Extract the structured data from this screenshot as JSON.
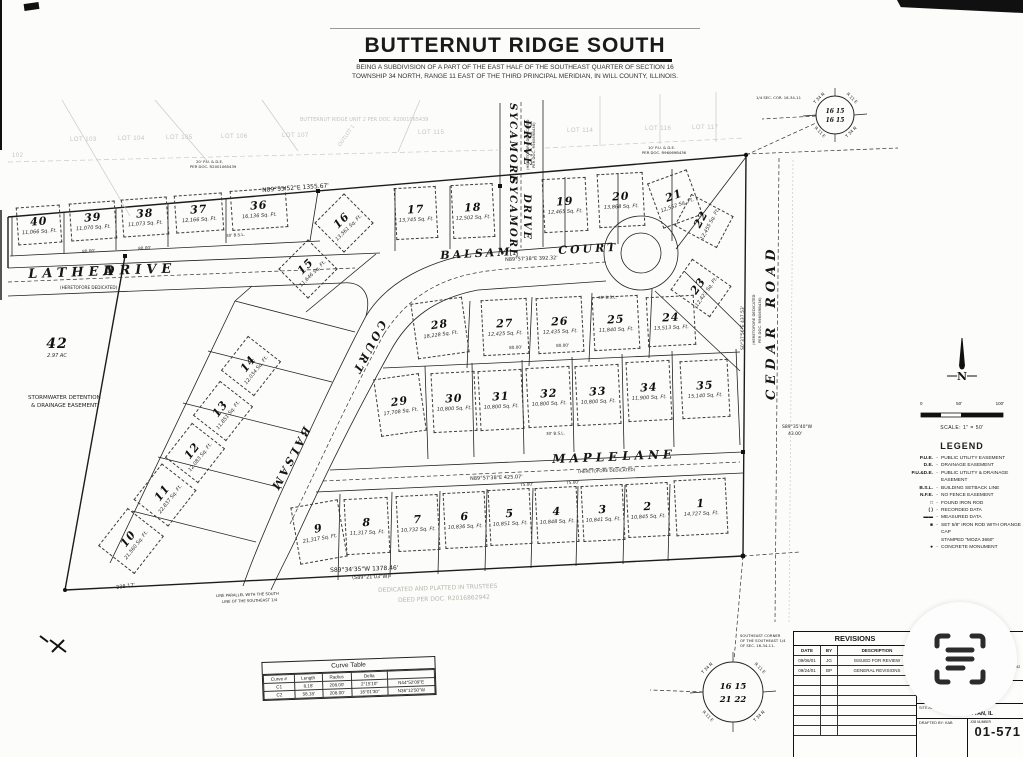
{
  "header": {
    "title": "BUTTERNUT RIDGE SOUTH",
    "subtitle_line1": "BEING A SUBDIVISION OF A PART OF THE EAST HALF OF THE SOUTHEAST QUARTER OF SECTION 16",
    "subtitle_line2": "TOWNSHIP 34 NORTH, RANGE 11 EAST OF THE THIRD PRINCIPAL MERIDIAN, IN WILL COUNTY, ILLINOIS."
  },
  "plat": {
    "lots": [
      {
        "n": "1",
        "area": "14,727 Sq. Ft.",
        "x": 700,
        "y": 506,
        "rot": -3,
        "w": 50,
        "h": 54
      },
      {
        "n": "2",
        "area": "10,845 Sq. Ft.",
        "x": 647,
        "y": 509,
        "rot": -3,
        "w": 40,
        "h": 52
      },
      {
        "n": "3",
        "area": "10,841 Sq. Ft.",
        "x": 602,
        "y": 512,
        "rot": -3,
        "w": 40,
        "h": 54
      },
      {
        "n": "4",
        "area": "10,848 Sq. Ft.",
        "x": 556,
        "y": 514,
        "rot": -3,
        "w": 40,
        "h": 54
      },
      {
        "n": "5",
        "area": "10,851 Sq. Ft.",
        "x": 509,
        "y": 516,
        "rot": -3,
        "w": 40,
        "h": 54
      },
      {
        "n": "6",
        "area": "10,836 Sq. Ft.",
        "x": 464,
        "y": 519,
        "rot": -3,
        "w": 40,
        "h": 54
      },
      {
        "n": "7",
        "area": "10,732 Sq. Ft.",
        "x": 417,
        "y": 522,
        "rot": -3,
        "w": 40,
        "h": 54
      },
      {
        "n": "8",
        "area": "11,317 Sq. Ft.",
        "x": 366,
        "y": 525,
        "rot": -3,
        "w": 42,
        "h": 54
      },
      {
        "n": "9",
        "area": "21,317 Sq. Ft.",
        "x": 318,
        "y": 531,
        "rot": -10,
        "w": 46,
        "h": 56
      },
      {
        "n": "10",
        "area": "21,560 Sq. Ft.",
        "x": 130,
        "y": 540,
        "rot": -52,
        "w": 46,
        "h": 44
      },
      {
        "n": "11",
        "area": "22,837 Sq. Ft.",
        "x": 164,
        "y": 494,
        "rot": -52,
        "w": 44,
        "h": 42
      },
      {
        "n": "12",
        "area": "12,083 Sq. Ft.",
        "x": 194,
        "y": 452,
        "rot": -52,
        "w": 42,
        "h": 40
      },
      {
        "n": "13",
        "area": "11,851 Sq. Ft.",
        "x": 222,
        "y": 410,
        "rot": -52,
        "w": 42,
        "h": 40
      },
      {
        "n": "14",
        "area": "12,034 Sq. Ft.",
        "x": 250,
        "y": 365,
        "rot": -52,
        "w": 42,
        "h": 40
      },
      {
        "n": "15",
        "area": "11,646 Sq. Ft.",
        "x": 307,
        "y": 268,
        "rot": -45,
        "w": 40,
        "h": 40
      },
      {
        "n": "16",
        "area": "13,561 Sq. Ft.",
        "x": 343,
        "y": 222,
        "rot": -45,
        "w": 40,
        "h": 40
      },
      {
        "n": "17",
        "area": "13,745 Sq. Ft.",
        "x": 415,
        "y": 212,
        "rot": -3,
        "w": 40,
        "h": 50
      },
      {
        "n": "18",
        "area": "12,502 Sq. Ft.",
        "x": 472,
        "y": 210,
        "rot": -3,
        "w": 40,
        "h": 52
      },
      {
        "n": "19",
        "area": "12,465 Sq. Ft.",
        "x": 564,
        "y": 204,
        "rot": -3,
        "w": 42,
        "h": 52
      },
      {
        "n": "20",
        "area": "13,868 Sq. Ft.",
        "x": 620,
        "y": 199,
        "rot": -3,
        "w": 44,
        "h": 52
      },
      {
        "n": "21",
        "area": "12,552 Sq. Ft.",
        "x": 674,
        "y": 198,
        "rot": -20,
        "w": 40,
        "h": 46
      },
      {
        "n": "22",
        "area": "12,455 Sq. Ft.",
        "x": 703,
        "y": 220,
        "rot": -62,
        "w": 34,
        "h": 46
      },
      {
        "n": "23",
        "area": "12,423 Sq. Ft.",
        "x": 700,
        "y": 287,
        "rot": -55,
        "w": 36,
        "h": 46
      },
      {
        "n": "24",
        "area": "13,513 Sq. Ft.",
        "x": 670,
        "y": 320,
        "rot": -3,
        "w": 46,
        "h": 48
      },
      {
        "n": "25",
        "area": "11,840 Sq. Ft.",
        "x": 615,
        "y": 322,
        "rot": -3,
        "w": 44,
        "h": 52
      },
      {
        "n": "26",
        "area": "12,435 Sq. Ft.",
        "x": 559,
        "y": 324,
        "rot": -3,
        "w": 44,
        "h": 54
      },
      {
        "n": "27",
        "area": "12,425 Sq. Ft.",
        "x": 504,
        "y": 326,
        "rot": -3,
        "w": 44,
        "h": 54
      },
      {
        "n": "28",
        "area": "18,228 Sq. Ft.",
        "x": 439,
        "y": 327,
        "rot": -8,
        "w": 50,
        "h": 54
      },
      {
        "n": "29",
        "area": "17,708 Sq. Ft.",
        "x": 399,
        "y": 404,
        "rot": -8,
        "w": 44,
        "h": 56
      },
      {
        "n": "30",
        "area": "10,800 Sq. Ft.",
        "x": 453,
        "y": 401,
        "rot": -3,
        "w": 42,
        "h": 58
      },
      {
        "n": "31",
        "area": "10,800 Sq. Ft.",
        "x": 500,
        "y": 399,
        "rot": -3,
        "w": 42,
        "h": 58
      },
      {
        "n": "32",
        "area": "10,800 Sq. Ft.",
        "x": 548,
        "y": 396,
        "rot": -3,
        "w": 42,
        "h": 58
      },
      {
        "n": "33",
        "area": "10,800 Sq. Ft.",
        "x": 597,
        "y": 394,
        "rot": -3,
        "w": 42,
        "h": 58
      },
      {
        "n": "34",
        "area": "11,900 Sq. Ft.",
        "x": 648,
        "y": 390,
        "rot": -3,
        "w": 42,
        "h": 58
      },
      {
        "n": "35",
        "area": "15,140 Sq. Ft.",
        "x": 704,
        "y": 388,
        "rot": -3,
        "w": 46,
        "h": 56
      },
      {
        "n": "36",
        "area": "16,136 Sq. Ft.",
        "x": 258,
        "y": 208,
        "rot": -4,
        "w": 54,
        "h": 38
      },
      {
        "n": "37",
        "area": "12,166 Sq. Ft.",
        "x": 198,
        "y": 212,
        "rot": -4,
        "w": 46,
        "h": 36
      },
      {
        "n": "38",
        "area": "11,073 Sq. Ft.",
        "x": 144,
        "y": 216,
        "rot": -4,
        "w": 44,
        "h": 36
      },
      {
        "n": "39",
        "area": "11,070 Sq. Ft.",
        "x": 92,
        "y": 220,
        "rot": -4,
        "w": 44,
        "h": 36
      },
      {
        "n": "40",
        "area": "11,066 Sq. Ft.",
        "x": 38,
        "y": 224,
        "rot": -4,
        "w": 42,
        "h": 36
      },
      {
        "n": "42",
        "area": "2.97 AC",
        "x": 57,
        "y": 350,
        "rot": 0,
        "w": 0,
        "h": 0
      }
    ],
    "adjacent_lots": [
      {
        "label": "102",
        "x": 12,
        "y": 153,
        "rot": 0
      },
      {
        "label": "LOT 103",
        "x": 70,
        "y": 137,
        "rot": 0
      },
      {
        "label": "LOT 104",
        "x": 118,
        "y": 136,
        "rot": 0
      },
      {
        "label": "LOT 105",
        "x": 166,
        "y": 135,
        "rot": 0
      },
      {
        "label": "LOT 106",
        "x": 221,
        "y": 134,
        "rot": 0
      },
      {
        "label": "LOT 107",
        "x": 282,
        "y": 133,
        "rot": 0
      },
      {
        "label": "LOT 115",
        "x": 418,
        "y": 130,
        "rot": 0
      },
      {
        "label": "LOT 114",
        "x": 567,
        "y": 128,
        "rot": 0
      },
      {
        "label": "LOT 116",
        "x": 645,
        "y": 126,
        "rot": 0
      },
      {
        "label": "LOT 117",
        "x": 692,
        "y": 125,
        "rot": 0
      }
    ],
    "street_labels": [
      {
        "text": "LATHEA",
        "x": 28,
        "y": 268,
        "rot": -2,
        "size": 13,
        "ls": 5
      },
      {
        "text": "DRIVE",
        "x": 103,
        "y": 265,
        "rot": -2,
        "size": 13,
        "ls": 5
      },
      {
        "text": "BALSAM",
        "x": 312,
        "y": 430,
        "rot": 118,
        "size": 11,
        "ls": 3
      },
      {
        "text": "COURT",
        "x": 388,
        "y": 324,
        "rot": 118,
        "size": 11,
        "ls": 3
      },
      {
        "text": "BALSAM",
        "x": 440,
        "y": 250,
        "rot": -3,
        "size": 11,
        "ls": 3
      },
      {
        "text": "COURT",
        "x": 558,
        "y": 245,
        "rot": -3,
        "size": 11,
        "ls": 3
      },
      {
        "text": "MAPLE",
        "x": 552,
        "y": 453,
        "rot": -2,
        "size": 12,
        "ls": 4
      },
      {
        "text": "LANE",
        "x": 622,
        "y": 450,
        "rot": -2,
        "size": 12,
        "ls": 4
      },
      {
        "text": "SYCAMORE",
        "x": 517,
        "y": 103,
        "rot": 90,
        "size": 10,
        "ls": 2
      },
      {
        "text": "DRIVE",
        "x": 531,
        "y": 120,
        "rot": 90,
        "size": 10,
        "ls": 2
      },
      {
        "text": "SYCAMORE",
        "x": 517,
        "y": 177,
        "rot": 90,
        "size": 10,
        "ls": 2
      },
      {
        "text": "DRIVE",
        "x": 531,
        "y": 194,
        "rot": 90,
        "size": 10,
        "ls": 2
      },
      {
        "text": "CEDAR",
        "x": 765,
        "y": 400,
        "rot": -90,
        "size": 13,
        "ls": 5
      },
      {
        "text": "ROAD",
        "x": 765,
        "y": 308,
        "rot": -90,
        "size": 13,
        "ls": 5
      }
    ],
    "annotations": [
      [
        "N89°55'52\"E  1355.67'",
        262,
        188,
        -4,
        6,
        "#222"
      ],
      [
        "N89°57'38\"E  392.32'",
        505,
        258,
        -2,
        5,
        "#222"
      ],
      [
        "N89°57'38\"E  425.07'",
        470,
        477,
        -2,
        5,
        "#222"
      ],
      [
        "S89°34'35\"W  1378.46'",
        330,
        568,
        -2,
        6,
        "#222"
      ],
      [
        "(S89°21'03\"W)",
        352,
        576,
        -2,
        5,
        "#222"
      ],
      [
        "238.17'",
        116,
        586,
        -8,
        5,
        "#222"
      ],
      [
        "S0°37'56\"E  437.53'",
        742,
        350,
        -90,
        4.5,
        "#222"
      ],
      [
        "(HERETOFORE DEDICATED",
        752,
        345,
        -90,
        3.8,
        "#222"
      ],
      [
        "PER DOC. R96069B436)",
        758,
        343,
        -90,
        3.8,
        "#222"
      ],
      [
        "S89°35'40\"W",
        782,
        426,
        0,
        4.5,
        "#222"
      ],
      [
        "43.00'",
        788,
        433,
        0,
        4.5,
        "#222"
      ],
      [
        "(HERETOFORE DEDICATED)",
        60,
        286,
        0,
        4.2,
        "#222"
      ],
      [
        "(HERETOFORE DEDICATED)",
        578,
        470,
        -2,
        4.2,
        "#222"
      ],
      [
        "(HERETOFORE DEDICATED",
        526,
        170,
        -90,
        3.8,
        "#222"
      ],
      [
        "PER DOC. R96069B436)",
        532,
        168,
        -90,
        3.8,
        "#222"
      ],
      [
        "STORMWATER DETENTION",
        28,
        396,
        0,
        5.5,
        "#222"
      ],
      [
        "& DRAINAGE EASEMENT",
        31,
        404,
        0,
        5.5,
        "#222"
      ],
      [
        "DEDICATED AND PLATTED IN TRUSTEES",
        378,
        588,
        -2,
        6,
        "#b9b4aa"
      ],
      [
        "DEED PER DOC. R2016862942",
        398,
        598,
        -2,
        6,
        "#b9b4aa"
      ],
      [
        "BUTTERNUT RIDGE UNIT 2 PER DOC. R2001065439",
        300,
        118,
        0,
        5,
        "#c4c4c0"
      ],
      [
        "OUTLOT 1",
        338,
        145,
        -55,
        5,
        "#c4c4c0"
      ],
      [
        "SOUTHEAST CORNER",
        740,
        634,
        0,
        3.8,
        "#222"
      ],
      [
        "OF THE SOUTHEAST 1/4",
        740,
        639,
        0,
        3.8,
        "#222"
      ],
      [
        "OF SEC. 16-34-11-",
        740,
        644,
        0,
        3.8,
        "#222"
      ],
      [
        "1/4 SEC. COR. 16-34-11",
        756,
        96,
        0,
        3.8,
        "#222"
      ],
      [
        "20' P.U. & D.E.",
        196,
        160,
        0,
        3.8,
        "#222"
      ],
      [
        "PER DOC. R2001065439",
        190,
        165,
        0,
        3.8,
        "#222"
      ],
      [
        "10' P.U. & D.E.",
        648,
        146,
        0,
        3.8,
        "#222"
      ],
      [
        "PER DOC. R96069B436",
        642,
        151,
        0,
        3.8,
        "#222"
      ],
      [
        "30' B.S.L.",
        226,
        234,
        -4,
        4,
        "#222"
      ],
      [
        "30' B.S.L.",
        598,
        296,
        -2,
        4,
        "#222"
      ],
      [
        "30' B.S.L.",
        546,
        432,
        -2,
        4,
        "#222"
      ],
      [
        "80.00'",
        82,
        250,
        -4,
        4.2,
        "#222"
      ],
      [
        "80.00'",
        138,
        247,
        -4,
        4.2,
        "#222"
      ],
      [
        "80.00'",
        509,
        346,
        -2,
        4.2,
        "#222"
      ],
      [
        "80.00'",
        556,
        344,
        -2,
        4.2,
        "#222"
      ],
      [
        "75.00'",
        520,
        483,
        -2,
        4.2,
        "#222"
      ],
      [
        "75.00'",
        566,
        481,
        -2,
        4.2,
        "#222"
      ],
      [
        "LINE PARALLEL WITH THE SOUTH",
        216,
        594,
        -2,
        3.8,
        "#222"
      ],
      [
        "LINE OF THE SOUTHEAST 1/4",
        222,
        600,
        -2,
        3.8,
        "#222"
      ]
    ]
  },
  "section_corners": {
    "top": {
      "row1": "16 15",
      "row2": "16 15",
      "tl": "T 34 N",
      "tr": "R 11 E",
      "bl": "R 11 E",
      "br": "T 34 N"
    },
    "bottom": {
      "row1": "16 15",
      "row2": "21 22",
      "tl": "T 34 N",
      "tr": "R 11 E",
      "bl": "R 11 E",
      "br": "T 34 N"
    }
  },
  "legend": {
    "title": "LEGEND",
    "north_label": "N",
    "scale_text": "SCALE:  1\" = 50'",
    "scale_ticks": [
      "0",
      "50'",
      "100'"
    ],
    "entries": [
      {
        "sym": "P.U.E.",
        "desc": "PUBLIC UTILITY EASEMENT"
      },
      {
        "sym": "D.E.",
        "desc": "DRAINAGE EASEMENT"
      },
      {
        "sym": "P.U.&D.E.",
        "desc": "PUBLIC UTILITY & DRAINAGE EASEMENT"
      },
      {
        "sym": "B.S.L.",
        "desc": "BUILDING SETBACK LINE"
      },
      {
        "sym": "N.F.E.",
        "desc": "NO FENCE EASEMENT"
      },
      {
        "sym": "□",
        "desc": "FOUND IRON ROD"
      },
      {
        "sym": "( )",
        "desc": "RECORDED DATA"
      },
      {
        "sym": "▬▬",
        "desc": "MEASURED DATA"
      },
      {
        "sym": "■",
        "desc": "SET 5/8\" IRON ROD WITH ORANGE CAP"
      },
      {
        "sym": "",
        "desc": "STAMPED \"MOZA 3660\""
      },
      {
        "sym": "●",
        "desc": "CONCRETE MONUMENT"
      }
    ]
  },
  "curve_table": {
    "title": "Curve Table",
    "headers": [
      "Curve #",
      "Length",
      "Radius",
      "Delta",
      ""
    ],
    "rows": [
      [
        "C1",
        "8.18'",
        "208.00'",
        "2°15'10\"",
        "N44°52'09\"E"
      ],
      [
        "C2",
        "58.18'",
        "208.00'",
        "16°01'30\"",
        "N36°12'50\"W"
      ]
    ]
  },
  "revisions": {
    "title": "REVISIONS",
    "headers": [
      "DATE",
      "BY",
      "DESCRIPTION"
    ],
    "rows": [
      [
        "09/06/01",
        "JG",
        "ISSUED FOR REVIEW"
      ],
      [
        "09/24/01",
        "BP",
        "GENERAL REVISIONS"
      ]
    ],
    "empty_row_count": 6
  },
  "title_block": {
    "logo_letter": "M",
    "firm_name_1": "MOZA ENGINEERING",
    "firm_name_2": "& SURVEYING",
    "firm_reg": "Professional Design Firm No. 184-005003",
    "firm_phone": "P. 815-478-9680    F. 815-478-9685",
    "firm_addr": "25620 S. GOUGAR RD., MANHATTAN, IL 60442",
    "ordered_by_label": "ORDERED BY:",
    "ordered_by": "LLOYD BISPING",
    "site_label": "SITE ADDRESS:",
    "site_address": "CEDAR ROAD MANHATTAN, IL",
    "drafted_label": "DRAFTED BY:",
    "drafted_by": "KAB",
    "job_label": "JOB NUMBER",
    "job_number": "01-571"
  }
}
